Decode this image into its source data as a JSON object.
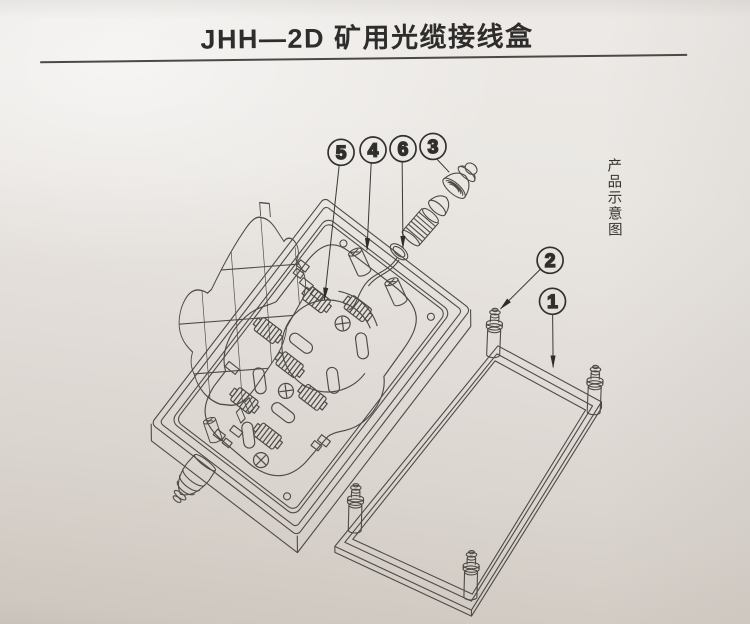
{
  "title": {
    "text": "JHH—2D 矿用光缆接线盒"
  },
  "side_caption": {
    "text": "产品示意图"
  },
  "callouts": {
    "c1": "1",
    "c2": "2",
    "c3": "3",
    "c4": "4",
    "c5": "5",
    "c6": "6"
  },
  "colors": {
    "paper_light": "#edeae7",
    "paper_dark": "#cfc8c1",
    "line": "#4e4b47",
    "ink": "#2f2d2b"
  }
}
